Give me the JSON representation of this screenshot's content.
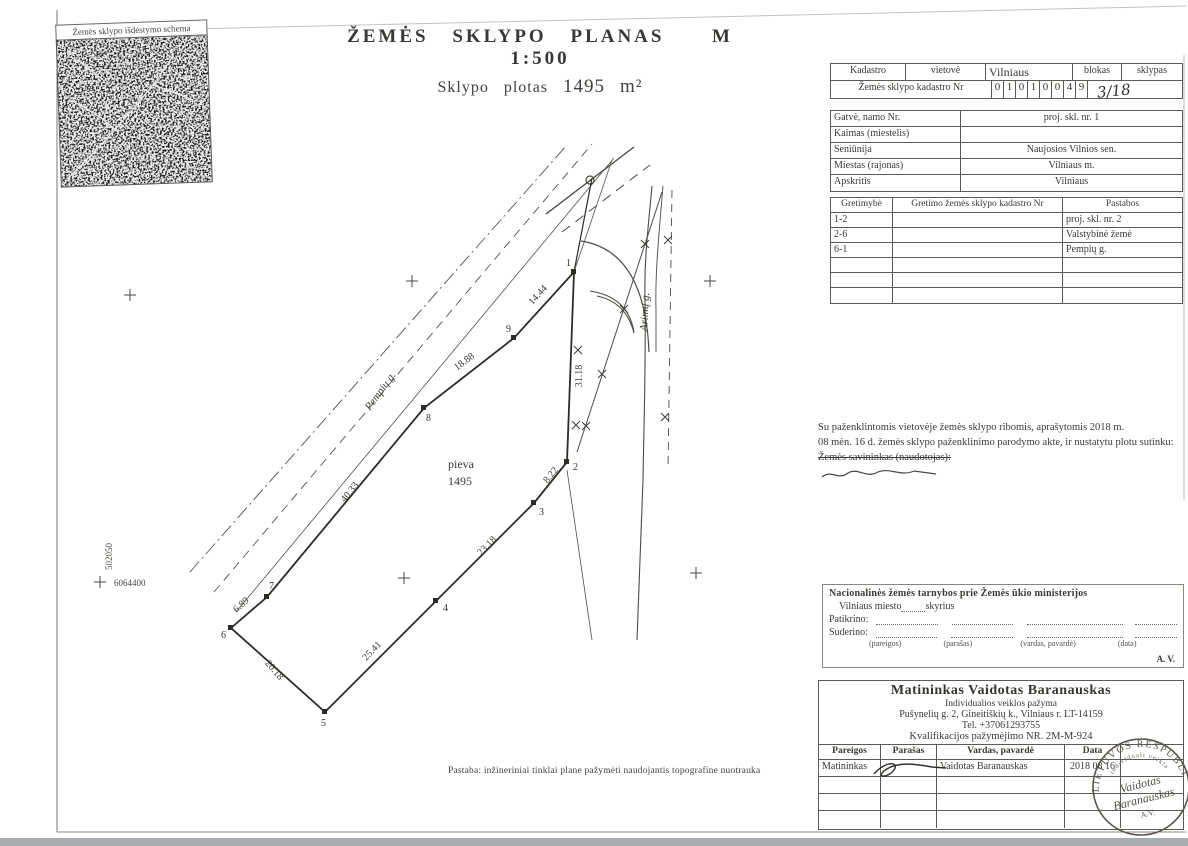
{
  "scheme": {
    "label": "Žemės sklypo išdėstymo schema"
  },
  "title": {
    "main": "ŽEMĖS SKLYPO PLANAS",
    "scale": "M 1:500",
    "area_prefix": "Sklypo plotas",
    "area_value": "1495",
    "area_unit": "m²"
  },
  "cadastral_table": {
    "col_kadastro": "Kadastro",
    "col_vietove": "vietovė",
    "vietove_value": "Vilniaus",
    "col_blokas": "blokas",
    "col_sklypas": "sklypas",
    "row2_label": "Žemės sklypo kadastro Nr",
    "digits": [
      "0",
      "1",
      "0",
      "1",
      "0",
      "0",
      "4",
      "9"
    ],
    "sklypas_value": "3/18"
  },
  "address_table": {
    "rows": [
      {
        "label": "Gatvė, namo Nr.",
        "value": "proj. skl. nr. 1"
      },
      {
        "label": "Kaimas (miestelis)",
        "value": ""
      },
      {
        "label": "Seniūnija",
        "value": "Naujosios Vilnios sen."
      },
      {
        "label": "Miestas (rajonas)",
        "value": "Vilniaus m."
      },
      {
        "label": "Apskritis",
        "value": "Vilniaus"
      }
    ]
  },
  "adjacency_table": {
    "headers": [
      "Gretimybė",
      "Gretimo žemės sklypo kadastro Nr",
      "Pastabos"
    ],
    "rows": [
      {
        "c1": "1-2",
        "c2": "",
        "c3": "proj. skl. nr. 2"
      },
      {
        "c1": "2-6",
        "c2": "",
        "c3": "Valstybinė žemė"
      },
      {
        "c1": "6-1",
        "c2": "",
        "c3": "Pempių g."
      },
      {
        "c1": "",
        "c2": "",
        "c3": ""
      },
      {
        "c1": "",
        "c2": "",
        "c3": ""
      },
      {
        "c1": "",
        "c2": "",
        "c3": ""
      }
    ]
  },
  "agreement": {
    "line1": "Su paženklintomis vietovėje žemės sklypo ribomis, aprašytomis 2018 m.",
    "line2": "08 mėn. 16 d. žemės sklypo paženklinimo parodymo akte, ir nustatytu plotu sutinku:",
    "line3": "Žemės savininkas (naudotojas):"
  },
  "nzt": {
    "title": "Nacionalinės žemės tarnybos prie Žemės ūkio ministerijos",
    "office": "Vilniaus miesto",
    "office_suffix": "skyrius",
    "checked_label": "Patikrino:",
    "agreed_label": "Suderino:",
    "col_labels": [
      "(pareigos)",
      "(parašas)",
      "(vardas, pavardė)",
      "(data)"
    ],
    "av": "A. V."
  },
  "surveyor": {
    "name_line": "Matininkas Vaidotas Baranauskas",
    "line2": "Individualios veiklos pažyma",
    "line3": "Pušynelių g. 2, Gineitiškių k., Vilniaus r. LT-14159",
    "line4": "Tel. +37061293755",
    "line5": "Kvalifikacijos pažymėjimo NR. 2M-M-924",
    "table_headers": [
      "Pareigos",
      "Parašas",
      "Vardas, pavardė",
      "Data"
    ],
    "row": {
      "pareigos": "Matininkas",
      "vardas": "Vaidotas Baranauskas",
      "data": "2018 08 16"
    }
  },
  "stamp": {
    "arc_top": "LIETUVOS RESPUBLIKA",
    "arc_small": "individuali veikla",
    "center1": "Vaidotas",
    "center2": "Baranauskas",
    "center3": "A.V."
  },
  "note": "Pastaba: inžineriniai tinklai plane pažymėti naudojantis topografine nuotrauka",
  "plan": {
    "area_label": "pieva",
    "area_value": "1495",
    "street_pempiu": "Pempių g.",
    "street_arimu": "Arimų g.",
    "coord_vertical": "502050",
    "coord_horizontal": "6064400",
    "dims": [
      "14.44",
      "18.88",
      "40.33",
      "6.89",
      "20.18",
      "25.41",
      "23.18",
      "8.22",
      "31.18"
    ],
    "vertices": [
      "1",
      "2",
      "3",
      "4",
      "5",
      "6",
      "7",
      "8",
      "9"
    ]
  }
}
